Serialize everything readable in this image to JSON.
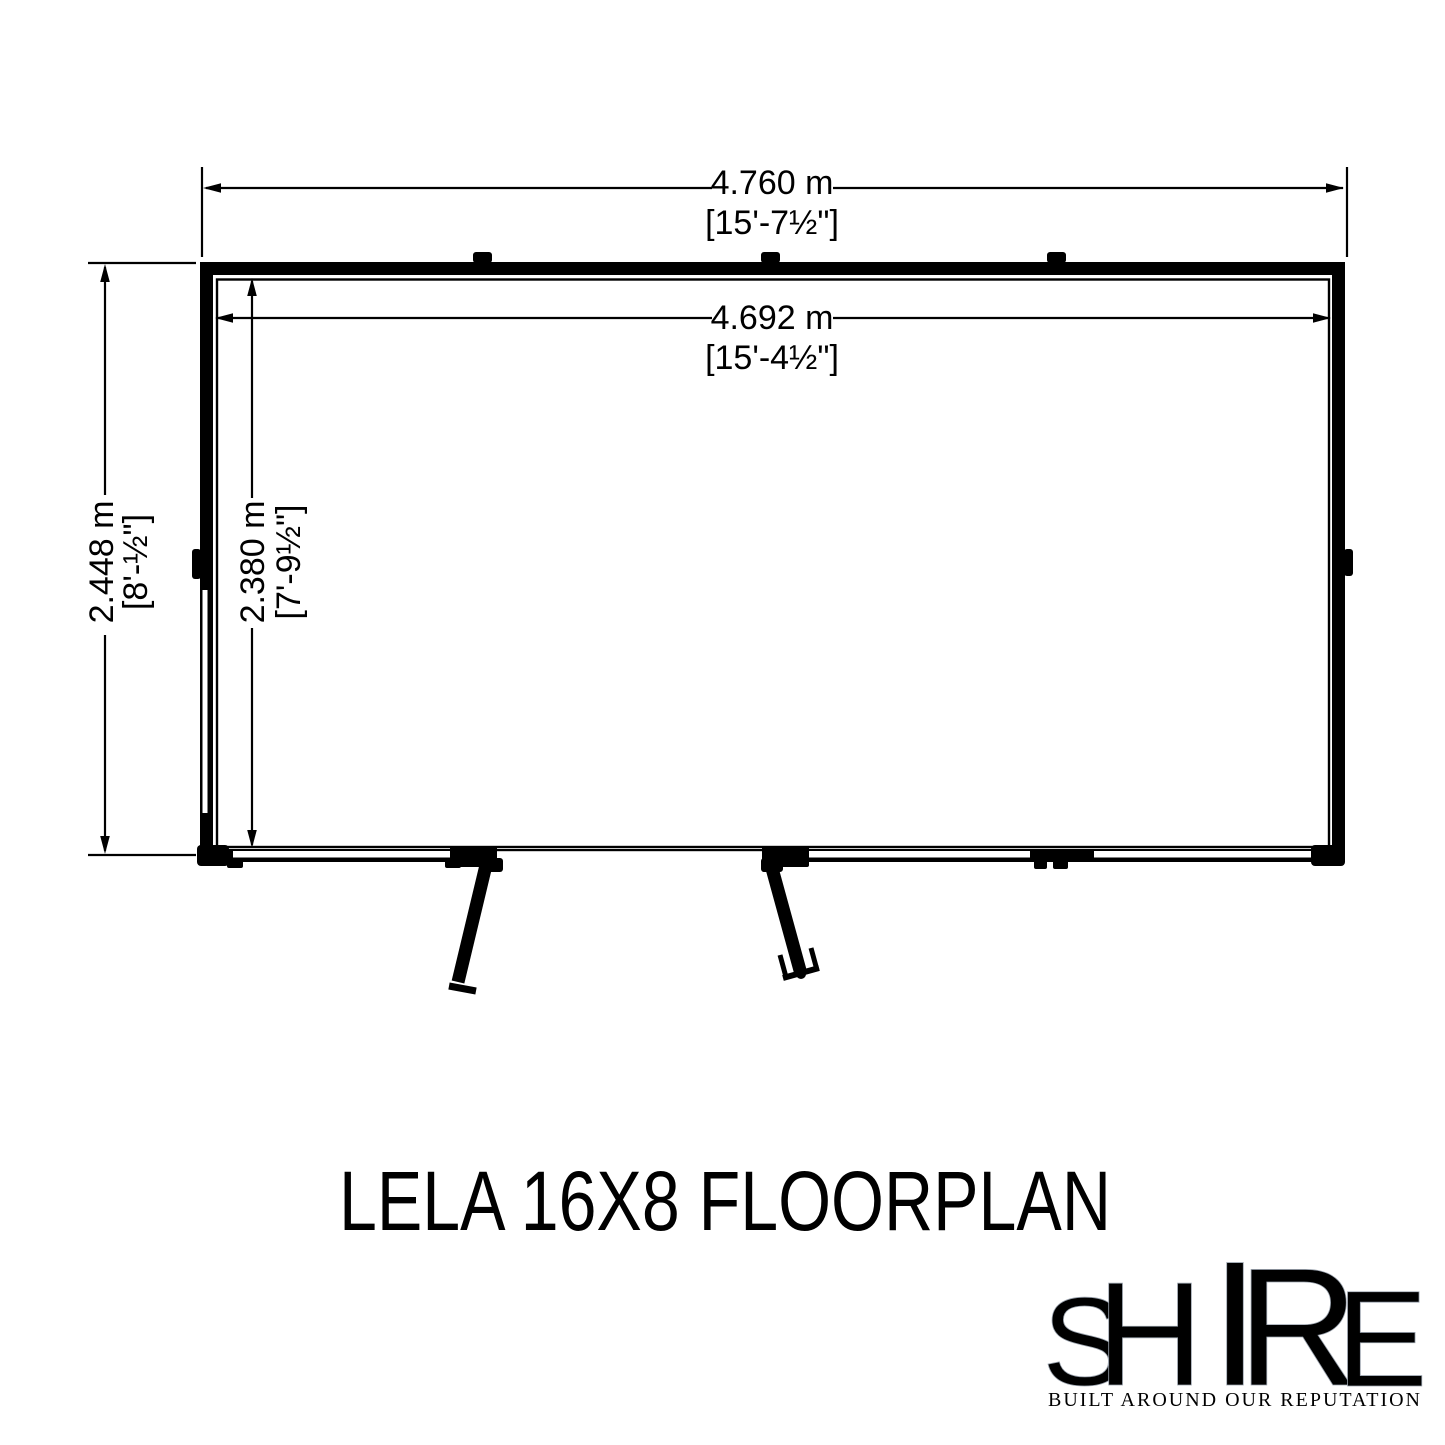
{
  "title": "LELA 16X8 FLOORPLAN",
  "floorplan": {
    "outer_width_metric": "4.760 m",
    "outer_width_imperial": "[15'-7½\"]",
    "inner_width_metric": "4.692 m",
    "inner_width_imperial": "[15'-4½\"]",
    "outer_depth_metric": "2.448 m",
    "outer_depth_imperial": "[8'-½\"]",
    "inner_depth_metric": "2.380 m",
    "inner_depth_imperial": "[7'-9½\"]",
    "line_color": "#000000"
  },
  "logo": {
    "name": "SHIRE",
    "letters": [
      "S",
      "H",
      "I",
      "R",
      "E"
    ],
    "tagline": "BUILT AROUND OUR REPUTATION",
    "flag_colors": {
      "blue": "#21356f",
      "red": "#c8102e",
      "white": "#e9edf2"
    },
    "tagline_color": "#5d4a42"
  }
}
